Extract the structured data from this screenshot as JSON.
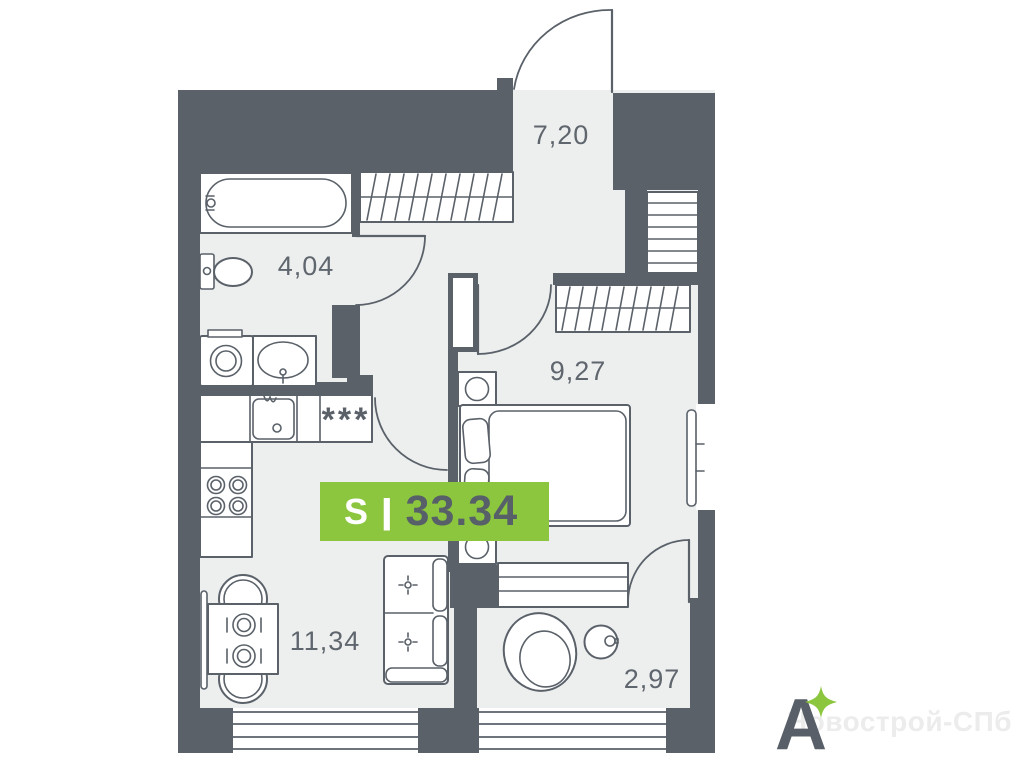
{
  "plan": {
    "rooms": {
      "hallway": {
        "area": "7,20"
      },
      "bathroom": {
        "area": "4,04"
      },
      "bedroom": {
        "area": "9,27"
      },
      "living_kitchen": {
        "area": "11,34"
      },
      "balcony": {
        "area": "2,97"
      }
    },
    "area_badge": {
      "series_label": "S",
      "divider": "|",
      "total_area": "33.34"
    },
    "symbols": {
      "fridge": "***"
    },
    "colors": {
      "walls": "#5a6169",
      "floor": "#edefef",
      "accent_green": "#8cc63e",
      "badge_text_dark": "#575f68",
      "label_text": "#60666e"
    }
  },
  "branding": {
    "logo_letter": "A",
    "watermark": "Новострой-СПб"
  }
}
